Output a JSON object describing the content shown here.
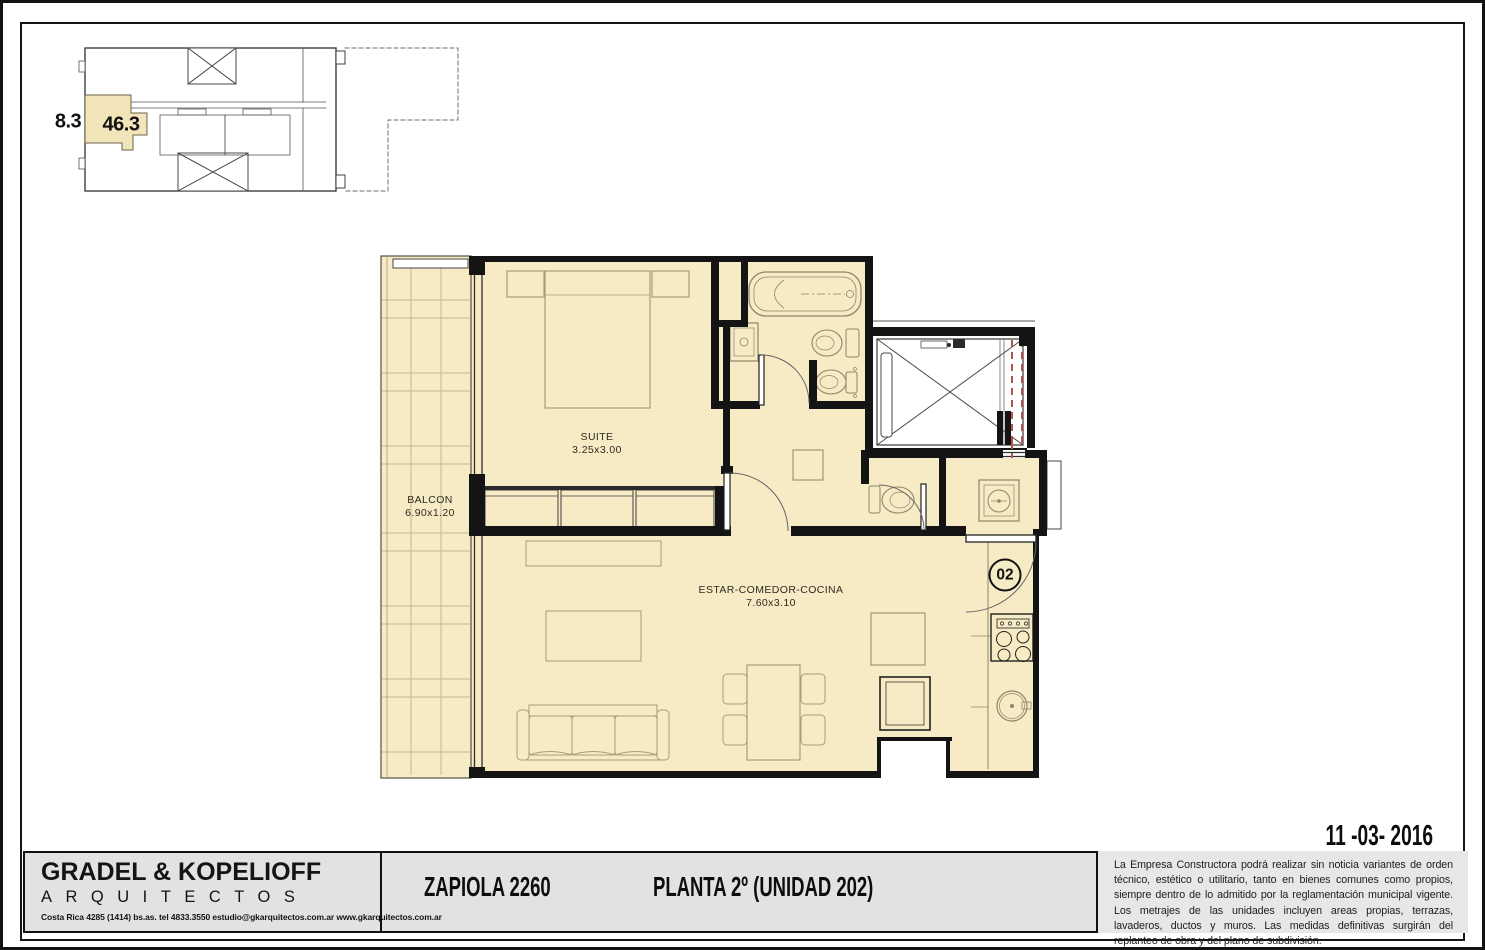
{
  "sheet": {
    "date": "11 -03- 2016"
  },
  "keyplan": {
    "adjacent_area": "8.3",
    "unit_area": "46.3"
  },
  "plan": {
    "balcony": {
      "name": "BALCON",
      "dims": "6.90x1.20"
    },
    "suite": {
      "name": "SUITE",
      "dims": "3.25x3.00"
    },
    "living": {
      "name": "ESTAR-COMEDOR-COCINA",
      "dims": "7.60x3.10"
    },
    "unit_number": "02"
  },
  "titleblock": {
    "firm_name": "GRADEL & KOPELIOFF",
    "firm_subtitle": "ARQUITECTOS",
    "firm_contact": "Costa Rica 4285 (1414) bs.as. tel 4833.3550 estudio@gkarquitectos.com.ar www.gkarquitectos.com.ar",
    "project": "ZAPIOLA 2260",
    "sheet_title": "PLANTA 2º (UNIDAD 202)",
    "disclaimer": "La Empresa Constructora podrá realizar sin noticia variantes de orden técnico, estético o utilitario, tanto en bienes comunes como propios, siempre dentro de lo admitido por la reglamentación municipal vigente. Los metrajes de las unidades incluyen areas propias, terrazas, lavaderos, ductos y muros. Las medidas definitivas surgirán del replanteo de obra y del plano de subdivisión."
  },
  "colors": {
    "floor_fill": "#f6ebc4",
    "keyplan_highlight": "#f3e5ba",
    "wall": "#141414",
    "door_swing_red": "#b5524e",
    "band_bg": "#e2e2e2"
  }
}
